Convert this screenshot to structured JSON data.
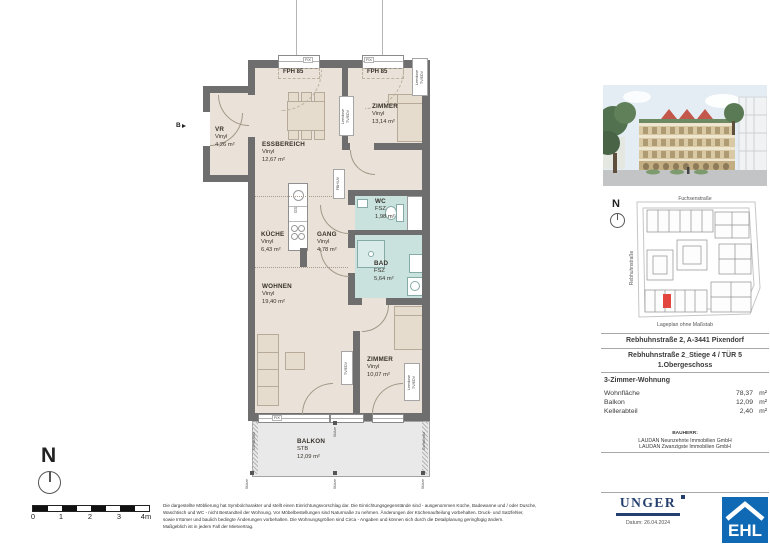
{
  "colors": {
    "wall": "#6e6e6e",
    "room_fill": "#eae2d8",
    "wet_fill": "#c9e2de",
    "balcony_fill": "#e9e9e9",
    "highlight_unit": "#e2463e",
    "unger_navy": "#25406f",
    "ehl_blue": "#0f69b4"
  },
  "plan": {
    "rooms": [
      {
        "name": "VR",
        "floor": "Vinyl",
        "area": "4,26 m²"
      },
      {
        "name": "ESSBEREICH",
        "floor": "Vinyl",
        "area": "12,67 m²"
      },
      {
        "name": "ZIMMER",
        "floor": "Vinyl",
        "area": "13,14 m²"
      },
      {
        "name": "WC",
        "floor": "FSZ",
        "area": "1,98 m²"
      },
      {
        "name": "BAD",
        "floor": "FSZ",
        "area": "5,64 m²"
      },
      {
        "name": "KÜCHE",
        "floor": "Vinyl",
        "area": "6,43 m²"
      },
      {
        "name": "GANG",
        "floor": "Vinyl",
        "area": "4,78 m²"
      },
      {
        "name": "WOHNEN",
        "floor": "Vinyl",
        "area": "19,40 m²"
      },
      {
        "name": "ZIMMER",
        "floor": "Vinyl",
        "area": "10,07 m²"
      },
      {
        "name": "BALKON",
        "floor": "STB",
        "area": "12,09 m²"
      }
    ],
    "labels": {
      "fph": "FPH 85",
      "fix": "FIX",
      "leerdose_line1": "Leerdose",
      "leerdose_line2": "TV/EDV",
      "tv_edv": "TV/EDV",
      "fbh_uv": "FBH/UV",
      "gs": "GS",
      "stuetze": "Stütze",
      "sichtschutz": "Sichtschutz",
      "section": "B"
    },
    "north_label": "N",
    "scale_ticks": [
      "0",
      "1",
      "2",
      "3",
      "4m"
    ]
  },
  "sidebar": {
    "siteplan": {
      "street_top": "Fuchsenstraße",
      "street_left": "Rebhuhnstraße",
      "north_label": "N",
      "caption": "Lageplan ohne Maßstab"
    },
    "info": {
      "address": "Rebhuhnstraße 2, A-3441 Pixendorf",
      "unit_line": "Rebhuhnstraße 2_Stiege 4 / TÜR 5",
      "floor_line": "1.Obergeschoss",
      "apartment_type": "3-Zimmer-Wohnung",
      "areas": [
        {
          "label": "Wohnfläche",
          "value": "78,37",
          "unit": "m²"
        },
        {
          "label": "Balkon",
          "value": "12,09",
          "unit": "m²"
        },
        {
          "label": "Kellerabteil",
          "value": "2,40",
          "unit": "m²"
        }
      ],
      "bauherr_heading": "BAUHERR:",
      "bauherr_line1": "LAUDAN Neunzehnte Immobilien GmbH",
      "bauherr_line2": "LAUDAN Zwanzigste Immobilien GmbH"
    },
    "unger_logo": "UNGER",
    "date_line": "Datum: 26.04.2024",
    "ehl_logo": "EHL"
  },
  "disclaimer": [
    "Die dargestellte Möblierung hat Symbolcharakter und stellt einen Einrichtungsvorschlag dar. Die Einrichtungsgegenstände sind - ausgenommen Küche, Badewanne und / oder Dusche,",
    "Waschtisch und WC - nicht Bestandteil der Wohnung. Vor Möbelbestellungen sind Naturmaße zu nehmen. Änderungen der Küchenaufteilung vorbehalten. Druck- und Satzfehler,",
    "sowie Irrtümer und baulich bedingte Änderungen vorbehalten. Die Wohnungsgrößen sind Circa - Angaben und können sich durch die Detailplanung geringfügig ändern.",
    "Maßgeblich ist in jedem Fall der Mietvertrag."
  ]
}
